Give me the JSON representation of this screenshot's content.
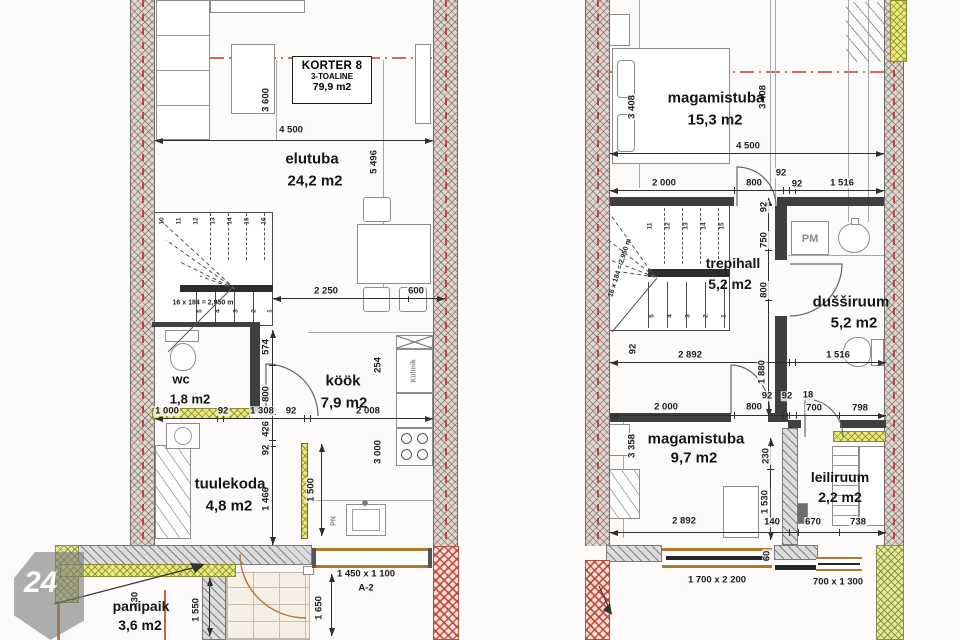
{
  "watermark": {
    "number": "24"
  },
  "title_block": {
    "name": "KORTER 8",
    "type": "3-TOALINE",
    "area": "79,9 m2"
  },
  "floor1": {
    "rooms": {
      "elutuba": {
        "name": "elutuba",
        "area": "24,2 m2"
      },
      "kook": {
        "name": "köök",
        "area": "7,9 m2"
      },
      "wc": {
        "name": "wc",
        "area": "1,8 m2"
      },
      "tuulekoda": {
        "name": "tuulekoda",
        "area": "4,8 m2"
      },
      "panipaik": {
        "name": "panipaik",
        "area": "3,6 m2"
      }
    },
    "labels": {
      "stair_note": "16 x 184 = 2,950 m",
      "fridge": "Külmik",
      "sink": "PN",
      "level": "-.30",
      "window_size": "1 450 x 1 100",
      "window_code": "A-2"
    },
    "stair_top": [
      "10",
      "11",
      "12",
      "13",
      "14",
      "15",
      "16"
    ],
    "stair_bottom": [
      "5",
      "4",
      "3",
      "2",
      "1"
    ],
    "dims": {
      "w4500": "4 500",
      "v3600": "3 600",
      "v5496": "5 496",
      "h2250": "2 250",
      "h600": "600",
      "v574": "574",
      "v800": "800",
      "v426": "426",
      "v92": "92",
      "v1466": "1 466",
      "h1000": "1 000",
      "h92a": "92",
      "h1308": "1 308",
      "h92b": "92",
      "h2008": "2 008",
      "v3000": "3 000",
      "v254": "254",
      "v1500": "1 500",
      "v1550": "1 550",
      "v1650": "1 650"
    }
  },
  "floor2": {
    "rooms": {
      "magamistuba1": {
        "name": "magamistuba",
        "area": "15,3 m2"
      },
      "trepihall": {
        "name": "trepihall",
        "area": "5,2 m2"
      },
      "dussiruum": {
        "name": "dušširuum",
        "area": "5,2 m2"
      },
      "magamistuba2": {
        "name": "magamistuba",
        "area": "9,7 m2"
      },
      "leiliruum": {
        "name": "leiliruum",
        "area": "2,2 m2"
      }
    },
    "labels": {
      "stair_note": "16 x 184 = 2,950 m",
      "washer": "PM",
      "window1": "1 700 x 2 200",
      "window2": "700 x 1 300"
    },
    "stair_top": [
      "11",
      "12",
      "13",
      "14",
      "15"
    ],
    "stair_bottom": [
      "5",
      "4",
      "3",
      "2",
      "1"
    ],
    "dims": {
      "v3408a": "3 408",
      "v3408b": "3 408",
      "w4500": "4 500",
      "h2000a": "2 000",
      "h800a": "800",
      "h92a": "92",
      "h92b": "92",
      "h1516a": "1 516",
      "v92a": "92",
      "v750": "750",
      "v800": "800",
      "v92b": "92",
      "h2892a": "2 892",
      "h1516b": "1 516",
      "v1880": "1 880",
      "h2000b": "2 000",
      "h800b": "800",
      "h92c": "92",
      "h92d": "92",
      "h18": "18",
      "h700": "700",
      "h798": "798",
      "v3358": "3 358",
      "v230": "230",
      "v1530": "1 530",
      "h2892b": "2 892",
      "h140": "140",
      "h670": "670",
      "h738": "738",
      "v60": "60"
    }
  }
}
